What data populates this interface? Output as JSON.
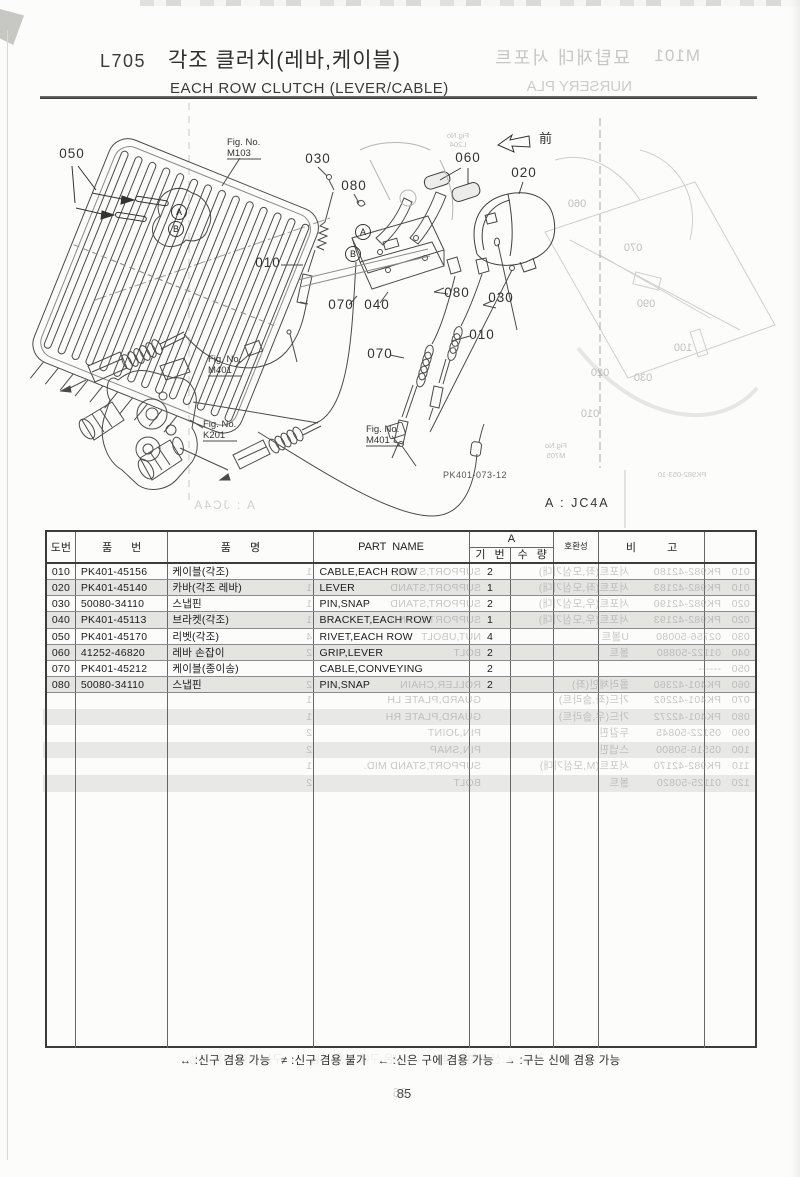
{
  "page": {
    "code": "L705",
    "title_ko": "각조 클러치(레바,케이블)",
    "title_en": "EACH ROW CLUTCH (LEVER/CABLE)",
    "variant_note": "A : JC4A",
    "drawing_no": "PK401-073-12",
    "front_label": "前",
    "page_number": "85",
    "footer_legend": "↔ :신구 겸용 가능   ≠ :신구 겸용 불가   ← :신은 구에 겸용 가능   → :구는 신에 겸용 가능"
  },
  "ghost_bleedthrough": {
    "code": "M101",
    "title_ko": "묘탑재대 서포트",
    "title_en": "NURSERY PLA",
    "variant_note": "A : JC4A",
    "page_number": "86",
    "drawing_no": "PK982-053-10"
  },
  "diagram": {
    "callouts": [
      {
        "t": "050",
        "x": 72,
        "y": 158
      },
      {
        "t": "030",
        "x": 318,
        "y": 163
      },
      {
        "t": "080",
        "x": 354,
        "y": 190
      },
      {
        "t": "010",
        "x": 268,
        "y": 267
      },
      {
        "t": "070",
        "x": 341,
        "y": 309
      },
      {
        "t": "040",
        "x": 377,
        "y": 309
      },
      {
        "t": "060",
        "x": 468,
        "y": 162
      },
      {
        "t": "020",
        "x": 524,
        "y": 177
      },
      {
        "t": "080",
        "x": 457,
        "y": 297
      },
      {
        "t": "030",
        "x": 501,
        "y": 302
      },
      {
        "t": "010",
        "x": 482,
        "y": 339
      },
      {
        "t": "070",
        "x": 380,
        "y": 358
      }
    ],
    "figure_refs": [
      {
        "l1": "Fig. No.",
        "l2": "M103",
        "x": 227,
        "y": 136
      },
      {
        "l1": "Fig. No.",
        "l2": "M401",
        "x": 208,
        "y": 353
      },
      {
        "l1": "Fig. No.",
        "l2": "K201",
        "x": 203,
        "y": 418
      },
      {
        "l1": "Fig. No.",
        "l2": "M401",
        "x": 366,
        "y": 423
      }
    ],
    "balloons": [
      {
        "t": "A",
        "x": 179,
        "y": 212
      },
      {
        "t": "B",
        "x": 176,
        "y": 229
      },
      {
        "t": "A",
        "x": 363,
        "y": 232
      },
      {
        "t": "B",
        "x": 353,
        "y": 254
      }
    ],
    "ghost_labels": [
      {
        "t": "060",
        "x": 223,
        "y": 207,
        "s": 11
      },
      {
        "t": "070",
        "x": 167,
        "y": 251,
        "s": 11
      },
      {
        "t": "090",
        "x": 154,
        "y": 307,
        "s": 11
      },
      {
        "t": "100",
        "x": 117,
        "y": 351,
        "s": 11
      },
      {
        "t": "020",
        "x": 200,
        "y": 376,
        "s": 11
      },
      {
        "t": "030",
        "x": 157,
        "y": 381,
        "s": 11
      },
      {
        "t": "010",
        "x": 210,
        "y": 417,
        "s": 11
      },
      {
        "t": "Fig.No",
        "x": 244,
        "y": 448,
        "s": 7.5
      },
      {
        "t": "M705",
        "x": 244,
        "y": 458,
        "s": 7.5
      },
      {
        "t": "PK982-053-10",
        "x": 118,
        "y": 477,
        "s": 7.5
      },
      {
        "t": "Fig.No",
        "x": 342,
        "y": 138,
        "s": 7.5
      },
      {
        "t": "L204",
        "x": 342,
        "y": 147,
        "s": 7.5
      }
    ]
  },
  "table": {
    "headers": {
      "no": "도번",
      "part_no": "품 번",
      "name_ko": "품 명",
      "part_name": "PART NAME",
      "group_a": "A",
      "serial": "기 번",
      "qty": "수 량",
      "compat": "호환성",
      "remark": "비 고"
    },
    "rows": [
      [
        "010",
        "PK401-45156",
        "케이블(각조)",
        "CABLE,EACH ROW",
        "2"
      ],
      [
        "020",
        "PK401-45140",
        "카바(각조 레바)",
        "LEVER",
        "1"
      ],
      [
        "030",
        "50080-34110",
        "스냅핀",
        "PIN,SNAP",
        "2"
      ],
      [
        "040",
        "PK401-45113",
        "브라켓(각조)",
        "BRACKET,EACH ROW",
        "1"
      ],
      [
        "050",
        "PK401-45170",
        "리벳(각조)",
        "RIVET,EACH ROW",
        "4"
      ],
      [
        "060",
        "41252-46820",
        "레바 손잡이",
        "GRIP,LEVER",
        "2"
      ],
      [
        "070",
        "PK401-45212",
        "케이블(종이송)",
        "CABLE,CONVEYING",
        "2"
      ],
      [
        "080",
        "50080-34110",
        "스냅핀",
        "PIN,SNAP",
        "2"
      ]
    ],
    "ghost_rows_overlap": [
      [
        "010",
        "PK982-42180",
        "서포트(좌,모심기대)",
        "SUPPORT,STAND",
        "1"
      ],
      [
        "010",
        "PK982-42183",
        "서포트(좌,모심기대)",
        "SUPPORT,STAND",
        "1"
      ],
      [
        "020",
        "PK982-42190",
        "서포트(우,모심기대)",
        "SUPPORT,STAND",
        "1"
      ],
      [
        "020",
        "PK982-42193",
        "서포트(우,모심기대)",
        "SUPPORT,STAND",
        "1"
      ],
      [
        "030",
        "02756-50080",
        "U볼트",
        "NUT,UBOLT",
        "4"
      ],
      [
        "040",
        "01122-50880",
        "볼트",
        "BOLT",
        "2"
      ],
      [
        "050",
        "------",
        "",
        "",
        ""
      ],
      [
        "060",
        "PK401-42360",
        "롤러체인(좌)",
        "ROLLER,CHAIN",
        "2"
      ]
    ],
    "ghost_rows_below": [
      [
        "070",
        "PK401-42262",
        "가드(좌,슬라트)",
        "GUARD,PLATE LH",
        "1"
      ],
      [
        "080",
        "PK401-42272",
        "가드(우,슬라트)",
        "GUARD,PLATE RH",
        "1"
      ],
      [
        "090",
        "05122-50845",
        "두갈핀",
        "PIN,JOINT",
        "2"
      ],
      [
        "100",
        "05516-50800",
        "스냅핀",
        "PIN,SNAP",
        "2"
      ],
      [
        "110",
        "PK982-42170",
        "서포트(M,모심기대)",
        "SUPPORT,STAND MID.",
        "1"
      ],
      [
        "120",
        "01125-50820",
        "볼트",
        "BOLT",
        "2"
      ]
    ]
  }
}
